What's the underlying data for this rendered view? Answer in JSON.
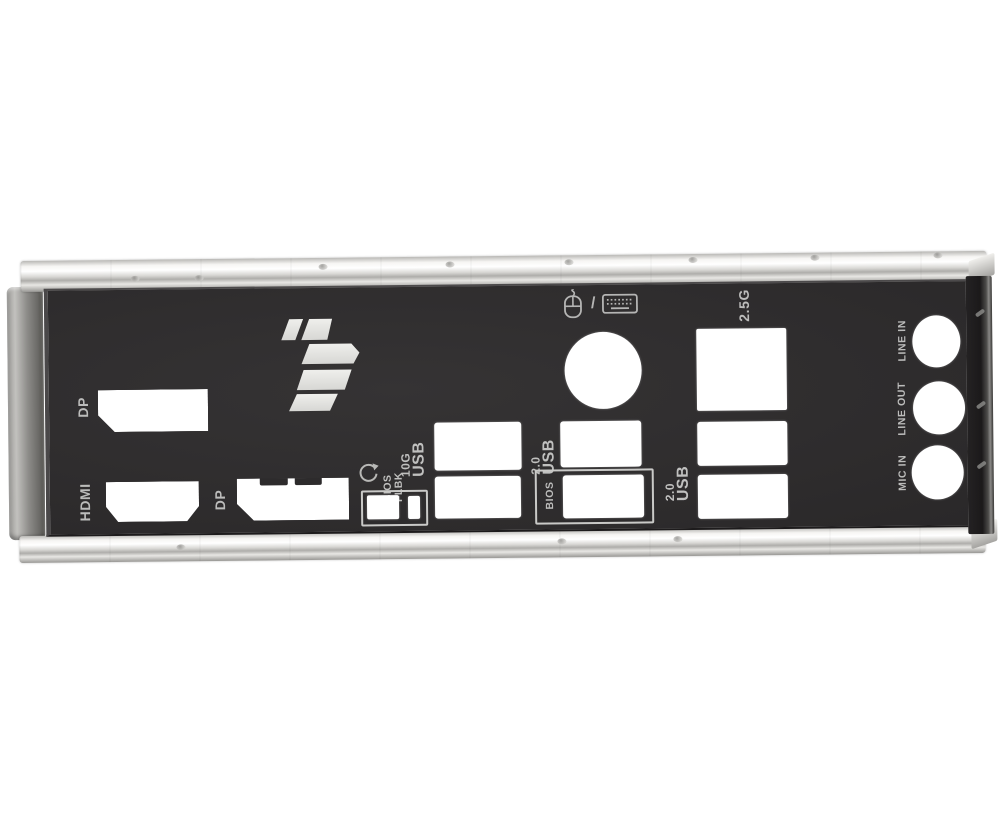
{
  "product": {
    "type": "motherboard rear I/O shield photo",
    "brand_mark": "TUF Gaming arrow logo"
  },
  "colors": {
    "background": "#ffffff",
    "plate": "#2f2d2e",
    "label": "#bcbcbb",
    "cutout": "#ffffff",
    "rail": "#d8d7d4",
    "logo": "#e7e7e4"
  },
  "labels": {
    "dp1": "DP",
    "hdmi": "HDMI",
    "dp2": "DP",
    "flbk_1": "BIOS",
    "flbk_2": "FLBK",
    "usb10g_1": "10G",
    "usb10g_2": "USB",
    "usb20a_1": "2.0",
    "usb20a_2": "USB",
    "bios": "BIOS",
    "lan": "2.5G",
    "usb20b_1": "2.0",
    "usb20b_2": "USB",
    "line_in": "LINE IN",
    "line_out": "LINE OUT",
    "mic_in": "MIC IN",
    "ps2_separator": "/"
  },
  "ports": [
    {
      "name": "displayport-1",
      "label": "DP"
    },
    {
      "name": "hdmi",
      "label": "HDMI"
    },
    {
      "name": "displayport-2",
      "label": "DP"
    },
    {
      "name": "bios-flashback-usb-and-button",
      "label": "BIOS FLBK"
    },
    {
      "name": "usb-10g-stack",
      "label": "10G USB"
    },
    {
      "name": "ps2-keyboard-mouse",
      "label": "mouse / keyboard"
    },
    {
      "name": "usb-2-0-left",
      "label": "2.0 USB"
    },
    {
      "name": "bios-usb",
      "label": "BIOS"
    },
    {
      "name": "lan-2-5g",
      "label": "2.5G"
    },
    {
      "name": "usb-2-0-right-stack",
      "label": "2.0 USB"
    },
    {
      "name": "audio-line-in",
      "label": "LINE IN"
    },
    {
      "name": "audio-line-out",
      "label": "LINE OUT"
    },
    {
      "name": "audio-mic-in",
      "label": "MIC IN"
    }
  ]
}
